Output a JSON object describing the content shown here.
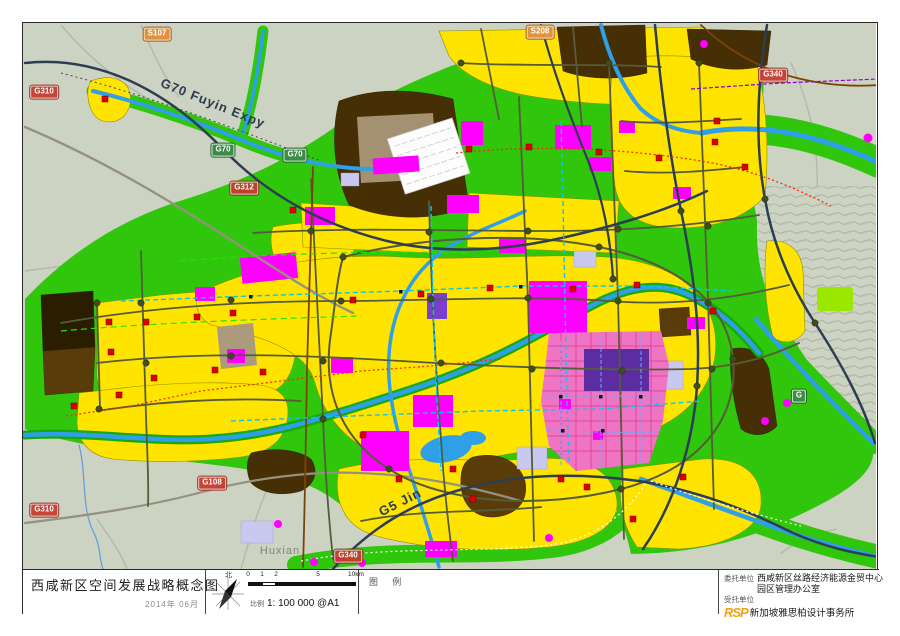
{
  "title_block": {
    "title": "西咸新区空间发展战略概念图",
    "date": "2014年 06月",
    "north_label": "北",
    "scale_label": "比例",
    "scale_value": "1: 100 000 @A1",
    "scale_ticks": [
      {
        "text": "0",
        "offset": 0
      },
      {
        "text": "1",
        "offset": 14
      },
      {
        "text": "2",
        "offset": 28
      },
      {
        "text": "5",
        "offset": 70
      },
      {
        "text": "10km",
        "offset": 108
      }
    ],
    "legend_label": "图 例",
    "client_label": "委托单位",
    "client_line1": "西咸新区丝路经济能源金贸中心",
    "client_line2": "园区管理办公室",
    "consultant_label": "受托单位",
    "consultant_logo": "RSP",
    "consultant_name": "新加坡雅思柏设计事务所"
  },
  "map": {
    "badges": [
      {
        "id": "s107",
        "text": "S107",
        "x": 157,
        "y": 34,
        "kind": "provincial"
      },
      {
        "id": "s208",
        "text": "S208",
        "x": 540,
        "y": 32,
        "kind": "provincial"
      },
      {
        "id": "g312",
        "text": "G312",
        "x": 244,
        "y": 188,
        "kind": "national"
      },
      {
        "id": "g310-north",
        "text": "G310",
        "x": 44,
        "y": 92,
        "kind": "national"
      },
      {
        "id": "g310-south",
        "text": "G310",
        "x": 44,
        "y": 510,
        "kind": "national"
      },
      {
        "id": "g108",
        "text": "G108",
        "x": 212,
        "y": 483,
        "kind": "national"
      },
      {
        "id": "g340-east",
        "text": "G340",
        "x": 773,
        "y": 75,
        "kind": "national"
      },
      {
        "id": "g340-south",
        "text": "G340",
        "x": 348,
        "y": 556,
        "kind": "national"
      },
      {
        "id": "g70-west",
        "text": "G70",
        "x": 223,
        "y": 150,
        "kind": "expressway"
      },
      {
        "id": "g70-mid",
        "text": "G70",
        "x": 295,
        "y": 155,
        "kind": "expressway"
      },
      {
        "id": "g-east",
        "text": "G",
        "x": 799,
        "y": 396,
        "kind": "expressway"
      }
    ],
    "road_labels": [
      {
        "id": "g70-fuyin",
        "text": "G70 Fuyin Expy",
        "x": 213,
        "y": 103,
        "rot": 22
      },
      {
        "id": "g5-jin",
        "text": "G5 Jin",
        "x": 400,
        "y": 502,
        "rot": -27
      }
    ],
    "place_labels": [
      {
        "id": "huxian",
        "text": "Huxian",
        "x": 280,
        "y": 551
      }
    ],
    "palette": {
      "background_plain": "#cdd3c3",
      "greenbelt": "#2fc60b",
      "urban_yellow": "#ffe400",
      "village_brown": "#472f05",
      "commercial_magenta": "#ff00ff",
      "core_pink": "#ef74c4",
      "core_purple": "#5b2da0",
      "river_blue": "#2f9fe8",
      "expressway_dark": "#2d3e52",
      "arterial_olive": "#565c39",
      "station_red": "#dd0000",
      "transit_cyan": "#00c8ff"
    }
  }
}
